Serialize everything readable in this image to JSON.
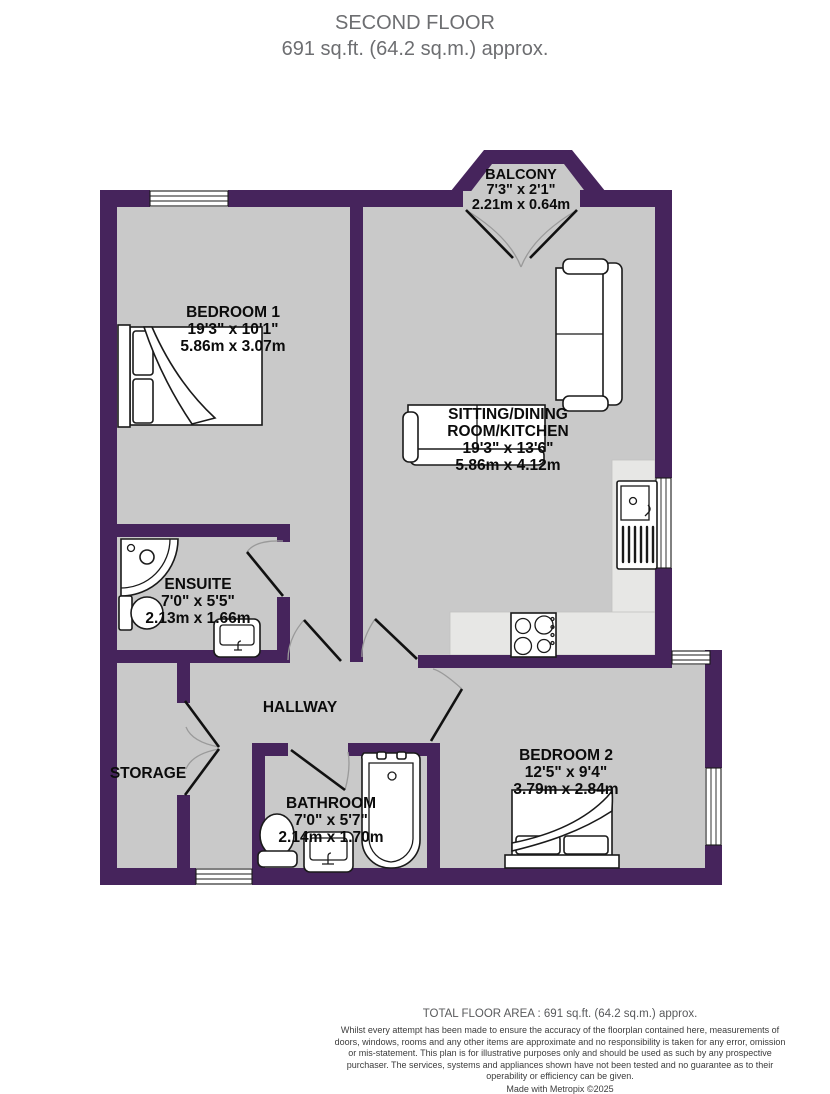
{
  "title": {
    "line1": "SECOND FLOOR",
    "line2": "691 sq.ft. (64.2 sq.m.) approx."
  },
  "colors": {
    "wall": "#46245c",
    "floor": "#c9c9c9",
    "counter": "#e7e7e5",
    "title_text": "#6d6e71",
    "label_text": "#0b0b0b"
  },
  "rooms": [
    {
      "name": "BALCONY",
      "imperial": "7'3\" x 2'1\"",
      "metric": "2.21m x 0.64m"
    },
    {
      "name": "BEDROOM 1",
      "imperial": "19'3\" x 10'1\"",
      "metric": "5.86m x 3.07m"
    },
    {
      "name_line1": "SITTING/DINING",
      "name_line2": "ROOM/KITCHEN",
      "imperial": "19'3\" x 13'6\"",
      "metric": "5.86m x 4.12m"
    },
    {
      "name": "ENSUITE",
      "imperial": "7'0\" x 5'5\"",
      "metric": "2.13m x 1.66m"
    },
    {
      "name": "HALLWAY"
    },
    {
      "name": "STORAGE"
    },
    {
      "name": "BATHROOM",
      "imperial": "7'0\" x 5'7\"",
      "metric": "2.14m x 1.70m"
    },
    {
      "name": "BEDROOM 2",
      "imperial": "12'5\" x 9'4\"",
      "metric": "3.79m x 2.84m"
    }
  ],
  "footer": {
    "total_area": "TOTAL FLOOR AREA : 691 sq.ft. (64.2 sq.m.) approx.",
    "disclaimer": "Whilst every attempt has been made to ensure the accuracy of the floorplan contained here, measurements of doors, windows, rooms and any other items are approximate and no responsibility is taken for any error, omission or mis-statement. This plan is for illustrative purposes only and should be used as such by any prospective purchaser. The services, systems and appliances shown have not been tested and no guarantee as to their operability or efficiency can be given.",
    "credit": "Made with Metropix ©2025"
  }
}
